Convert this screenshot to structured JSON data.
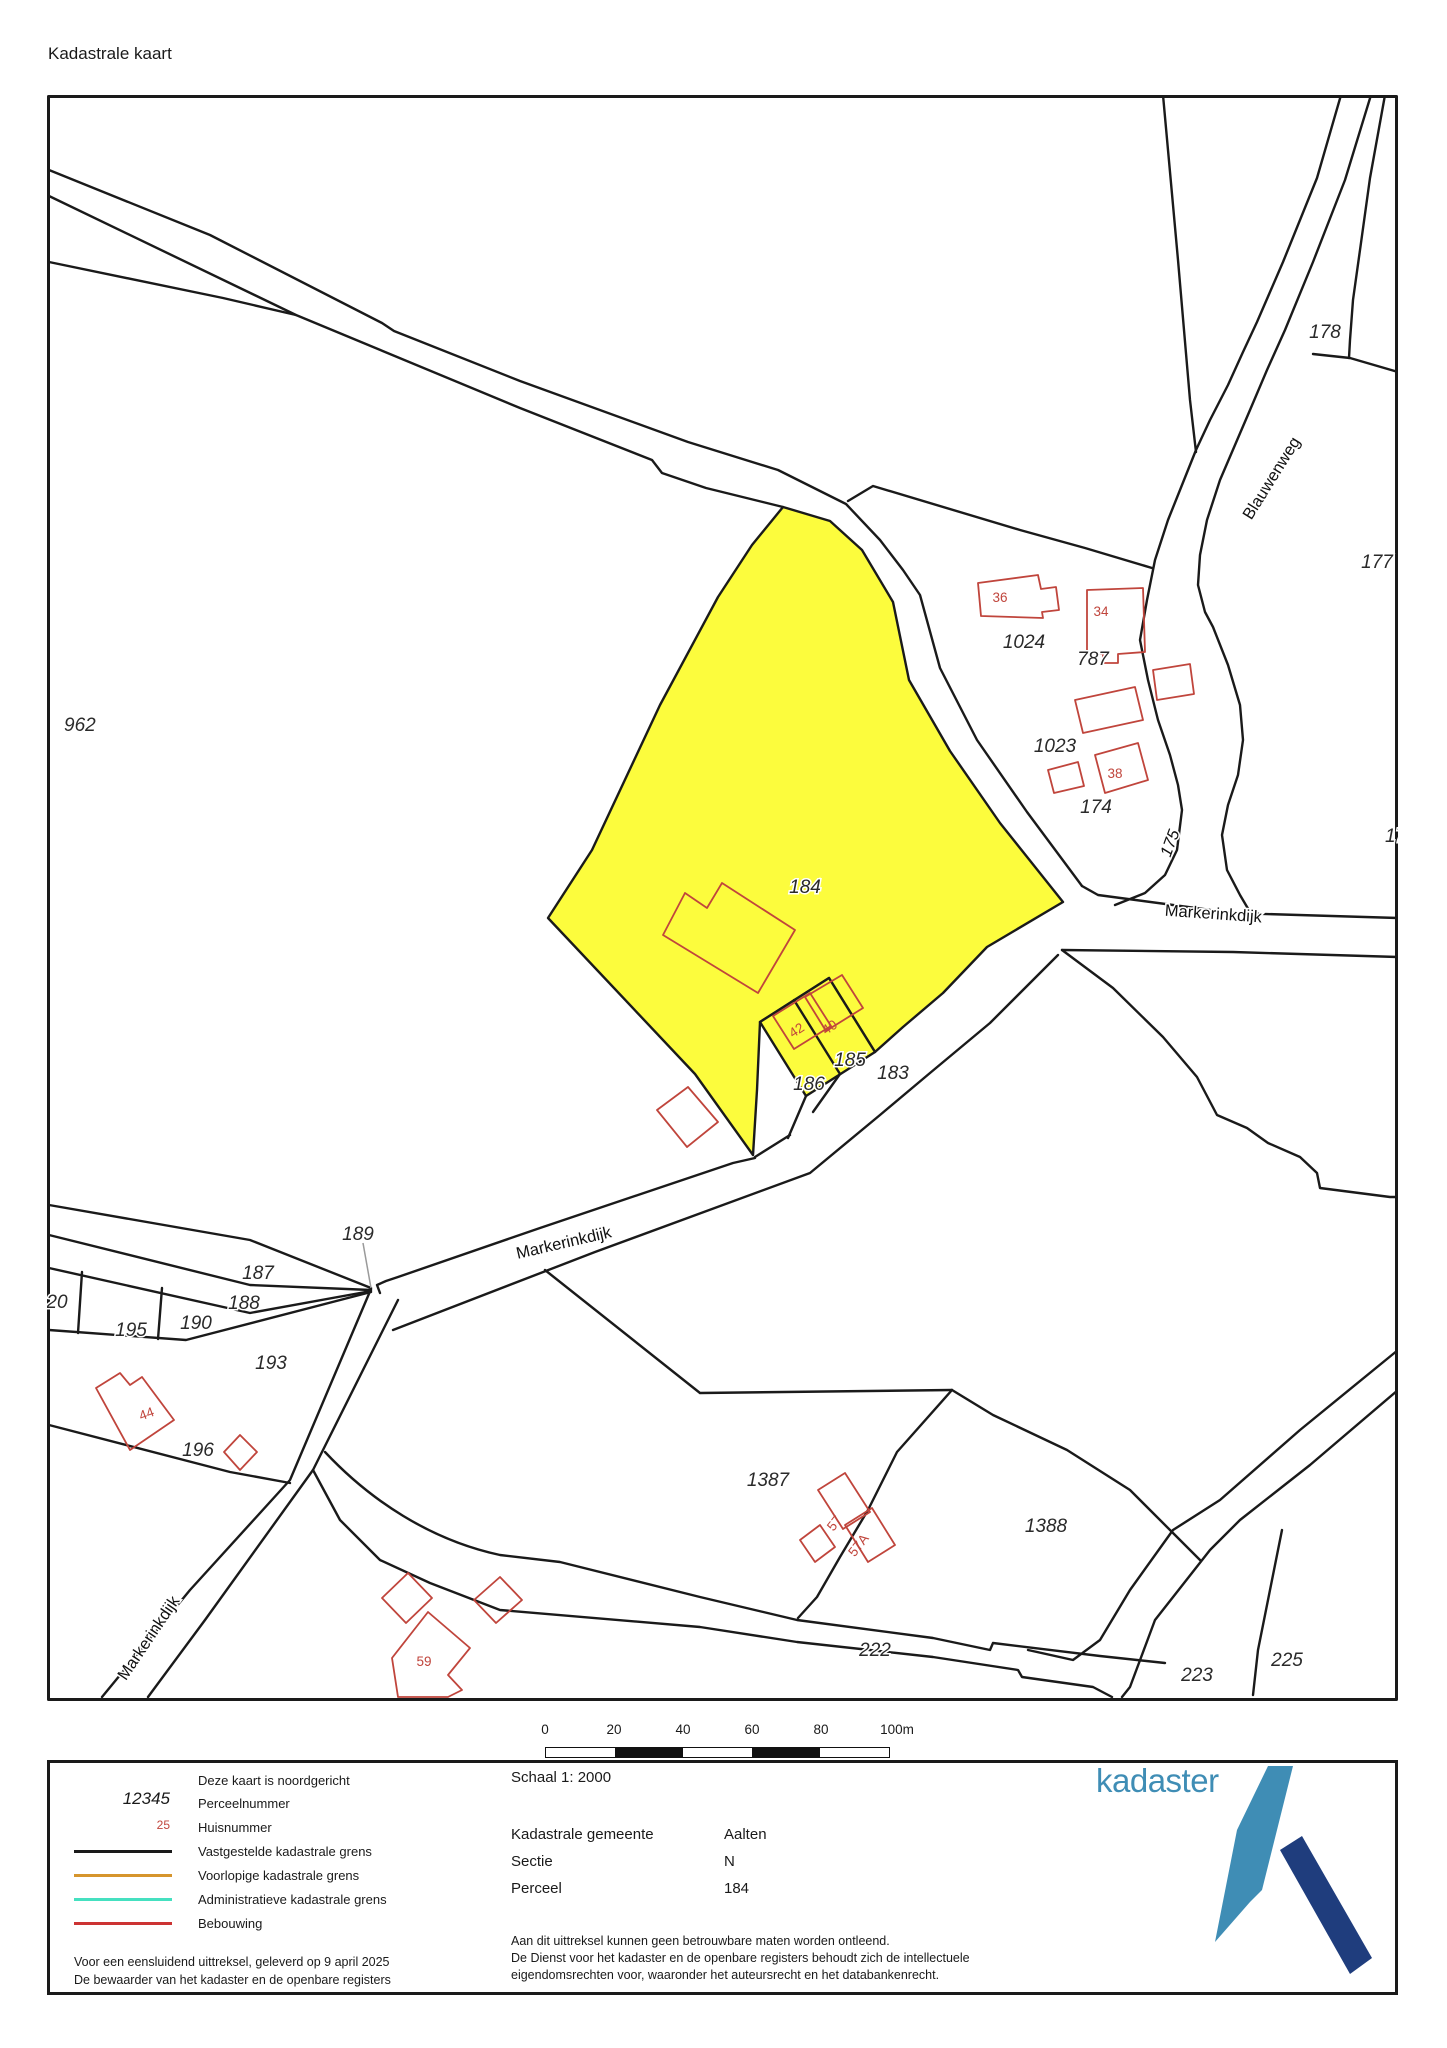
{
  "title": "Kadastrale kaart",
  "map": {
    "highlight_color": "#fcfc3d",
    "building_color": "#c0453c",
    "parcel_labels": {
      "p962": "962",
      "p178": "178",
      "p177": "177",
      "p17": "17",
      "p1024": "1024",
      "p787": "787",
      "p1023": "1023",
      "p174": "174",
      "p184": "184",
      "p185": "185",
      "p186": "186",
      "p183": "183",
      "p189": "189",
      "p187": "187",
      "p188": "188",
      "p190": "190",
      "p195": "195",
      "p20": "20",
      "p193": "193",
      "p196": "196",
      "p1387": "1387",
      "p1388": "1388",
      "p222": "222",
      "p223": "223",
      "p225": "225"
    },
    "house_numbers": {
      "h36": "36",
      "h34": "34",
      "h38": "38",
      "h42": "42",
      "h40": "40",
      "h44": "44",
      "h57": "57",
      "h57a": "57A",
      "h59": "59"
    },
    "road_names": {
      "blauwenweg": "Blauwenweg",
      "markerinkdijk_east": "Markerinkdijk",
      "markerinkdijk_center": "Markerinkdijk",
      "markerinkdijk_south": "Markerinkdijk"
    }
  },
  "scalebar": {
    "ticks": [
      "0",
      "20",
      "40",
      "60",
      "80",
      "100m"
    ]
  },
  "legend": {
    "north_note": "Deze kaart is noordgericht",
    "items": {
      "perceelnummer": {
        "sample": "12345",
        "label": "Perceelnummer"
      },
      "huisnummer": {
        "sample": "25",
        "label": "Huisnummer"
      },
      "vastgesteld": {
        "label": "Vastgestelde kadastrale grens",
        "color": "#1a1a1a"
      },
      "voorlopig": {
        "label": "Voorlopige kadastrale grens",
        "color": "#d6952d"
      },
      "administratief": {
        "label": "Administratieve kadastrale grens",
        "color": "#45e0c0"
      },
      "bebouwing": {
        "label": "Bebouwing",
        "color": "#cc3333"
      }
    },
    "issued_line1": "Voor een eensluidend uittreksel, geleverd op 9 april 2025",
    "issued_line2": "De bewaarder van het kadaster en de openbare registers"
  },
  "info_panel": {
    "scale_label": "Schaal 1: 2000",
    "rows": [
      {
        "label": "Kadastrale gemeente",
        "value": "Aalten"
      },
      {
        "label": "Sectie",
        "value": "N"
      },
      {
        "label": "Perceel",
        "value": "184"
      }
    ],
    "disclaimer_line1": "Aan dit uittreksel kunnen geen betrouwbare maten worden ontleend.",
    "disclaimer_line2": "De Dienst voor het kadaster en de openbare registers behoudt zich de intellectuele",
    "disclaimer_line3": "eigendomsrechten voor, waaronder het auteursrecht en het databankenrecht."
  },
  "logo": {
    "text": "kadaster",
    "light_color": "#3f8db5",
    "dark_color": "#1f3d7d"
  }
}
